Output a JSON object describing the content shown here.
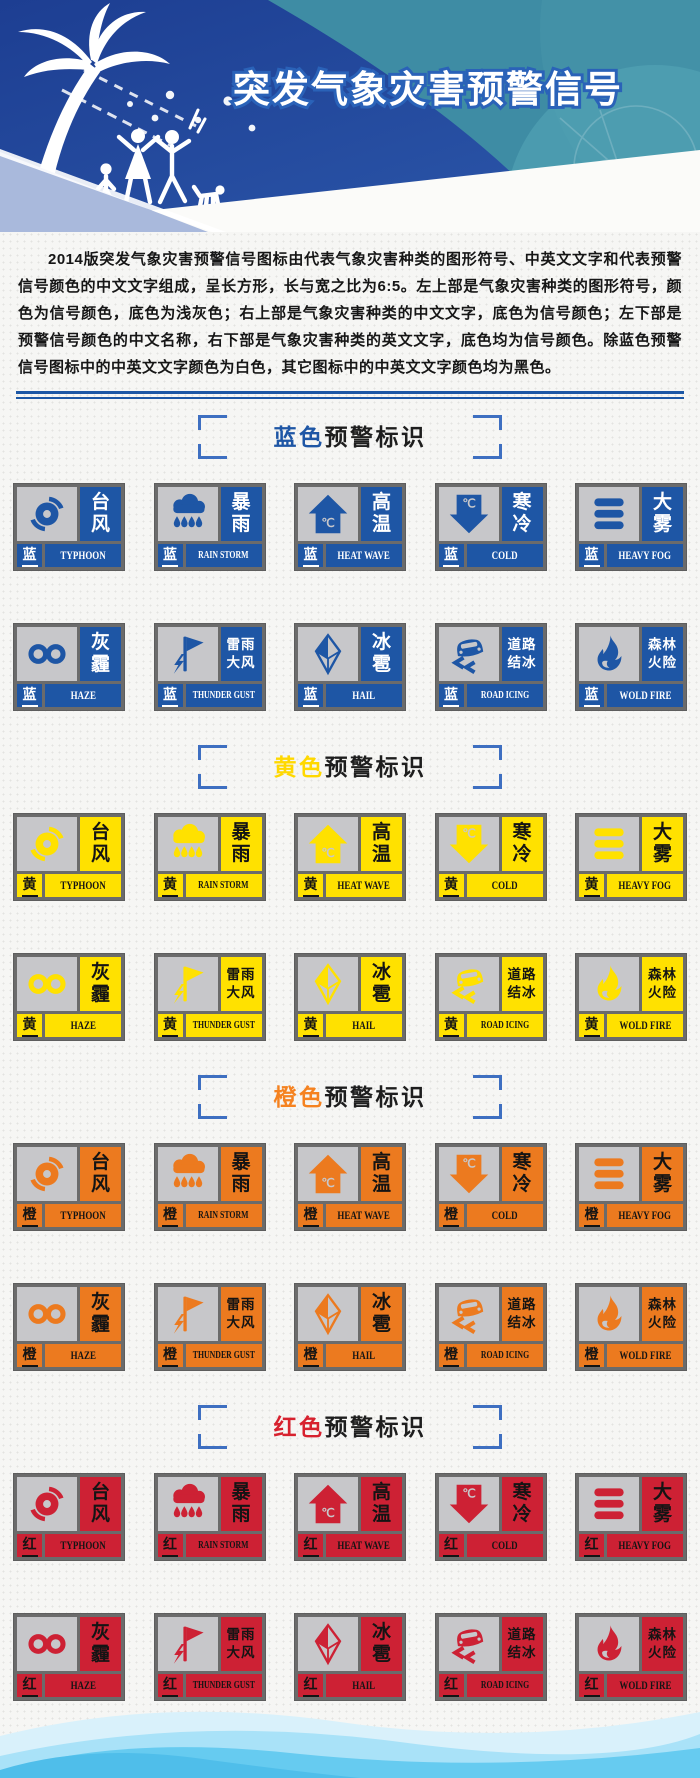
{
  "banner": {
    "title": "突发气象灾害预警信号"
  },
  "intro": "2014版突发气象灾害预警信号图标由代表气象灾害种类的图形符号、中英文文字和代表预警信号颜色的中文文字组成，呈长方形，长与宽之比为6:5。左上部是气象灾害种类的图形符号，颜色为信号颜色，底色为浅灰色；右上部是气象灾害种类的中文文字，底色为信号颜色；左下部是预警信号颜色的中文名称，右下部是气象灾害种类的英文文字，底色均为信号颜色。除蓝色预警信号图标中的中英文文字颜色为白色，其它图标中的中英文文字颜色均为黑色。",
  "colors": {
    "banner_blue": "#24489B",
    "banner_teal": "#3E8CA4",
    "divider_blue": "#1C57A5",
    "bracket_blue": "#3E6FC1",
    "card_border_gray": "#6B6B6B",
    "icon_bg_gray": "#C7C7CA",
    "blue_signal": "#1E56A5",
    "yellow_signal": "#FFE100",
    "orange_signal": "#EC7A1F",
    "red_signal": "#CD2134"
  },
  "warning_types": [
    {
      "zh": "台风",
      "zh_lines": [
        "台",
        "风"
      ],
      "en": "TYPHOON",
      "icon": "typhoon-icon"
    },
    {
      "zh": "暴雨",
      "zh_lines": [
        "暴",
        "雨"
      ],
      "en": "RAIN STORM",
      "icon": "rainstorm-icon"
    },
    {
      "zh": "高温",
      "zh_lines": [
        "高",
        "温"
      ],
      "en": "HEAT WAVE",
      "icon": "heatwave-icon"
    },
    {
      "zh": "寒冷",
      "zh_lines": [
        "寒",
        "冷"
      ],
      "en": "COLD",
      "icon": "cold-icon"
    },
    {
      "zh": "大雾",
      "zh_lines": [
        "大",
        "雾"
      ],
      "en": "HEAVY FOG",
      "icon": "fog-icon"
    },
    {
      "zh": "灰霾",
      "zh_lines": [
        "灰",
        "霾"
      ],
      "en": "HAZE",
      "icon": "haze-icon"
    },
    {
      "zh": "雷雨大风",
      "zh_lines": [
        "雷雨",
        "大风"
      ],
      "en": "THUNDER GUST",
      "icon": "thunder-gust-icon"
    },
    {
      "zh": "冰雹",
      "zh_lines": [
        "冰",
        "雹"
      ],
      "en": "HAIL",
      "icon": "hail-icon"
    },
    {
      "zh": "道路结冰",
      "zh_lines": [
        "道路",
        "结冰"
      ],
      "en": "ROAD ICING",
      "icon": "road-icing-icon"
    },
    {
      "zh": "森林火险",
      "zh_lines": [
        "森林",
        "火险"
      ],
      "en": "WOLD FIRE",
      "icon": "wildfire-icon"
    }
  ],
  "sections": [
    {
      "name": "blue",
      "label_colored": "蓝色",
      "label_rest": "预警标识",
      "label_hex": "#1E56A5",
      "badge": "蓝",
      "signal_color": "#1E56A5",
      "text_color": "#FFFFFF"
    },
    {
      "name": "yellow",
      "label_colored": "黄色",
      "label_rest": "预警标识",
      "label_hex": "#FFD800",
      "badge": "黄",
      "signal_color": "#FFE100",
      "text_color": "#141414"
    },
    {
      "name": "orange",
      "label_colored": "橙色",
      "label_rest": "预警标识",
      "label_hex": "#F58220",
      "badge": "橙",
      "signal_color": "#EC7A1F",
      "text_color": "#141414"
    },
    {
      "name": "red",
      "label_colored": "红色",
      "label_rest": "预警标识",
      "label_hex": "#D7212E",
      "badge": "红",
      "signal_color": "#CD2134",
      "text_color": "#141414"
    }
  ]
}
